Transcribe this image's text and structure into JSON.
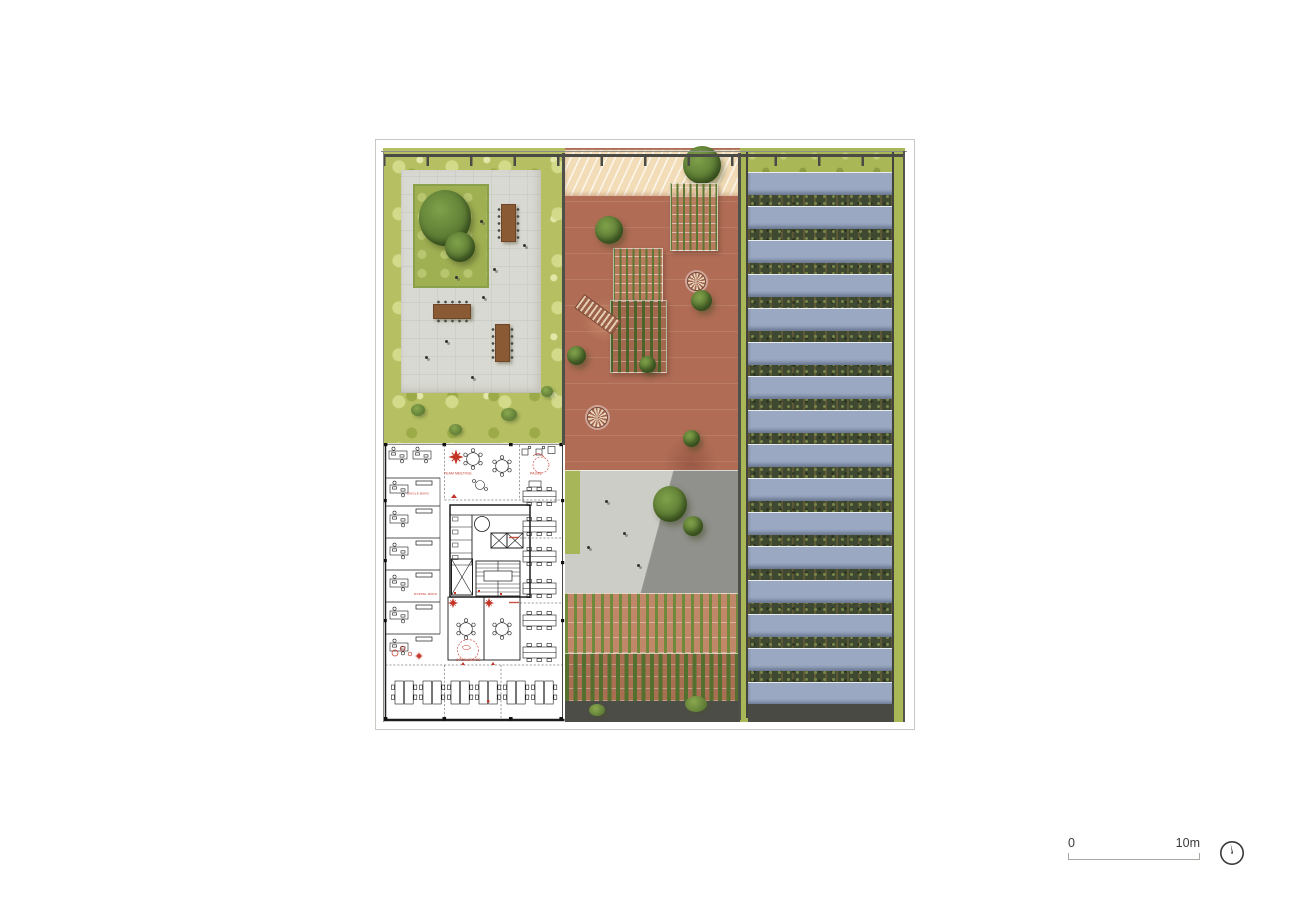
{
  "page": {
    "background": "#ffffff",
    "content": "architectural roof plan, aerial render"
  },
  "plan": {
    "zones": {
      "green_roof": "green roof terrace with picnic tables",
      "terraces": "terracotta roof terraces with pergolas and spiral stairs",
      "solar_field": "photovoltaic panel field over extensive green roof",
      "floor_plan": "office floor plan"
    },
    "solar": {
      "row_count": 16,
      "panels_per_row": 13
    },
    "colors": {
      "meadow_green": "#b6c062",
      "paving_grey": "#d9d9d3",
      "terracotta": "#b06c55",
      "awning_cream": "#f3ddb8",
      "vine_green": "#6f8f3f",
      "panel_blue": "#9aa8c2",
      "panel_gap_green": "#3f4830",
      "frame_dark": "#4b4b45",
      "plan_line": "#1c1c1c",
      "annotation_red": "#c23527",
      "table_wood": "#8a5a35"
    }
  },
  "floorplan": {
    "labels": {
      "team_meeting": "TEAM MEETING",
      "pause": "PAUSE",
      "single_office": "SINGLE BÜRO",
      "double_office": "DOPPEL BÜRO",
      "open_office": "OPEN OFFICE"
    },
    "annotation_color": "#c23527"
  },
  "scale_bar": {
    "start": "0",
    "end": "10m"
  }
}
